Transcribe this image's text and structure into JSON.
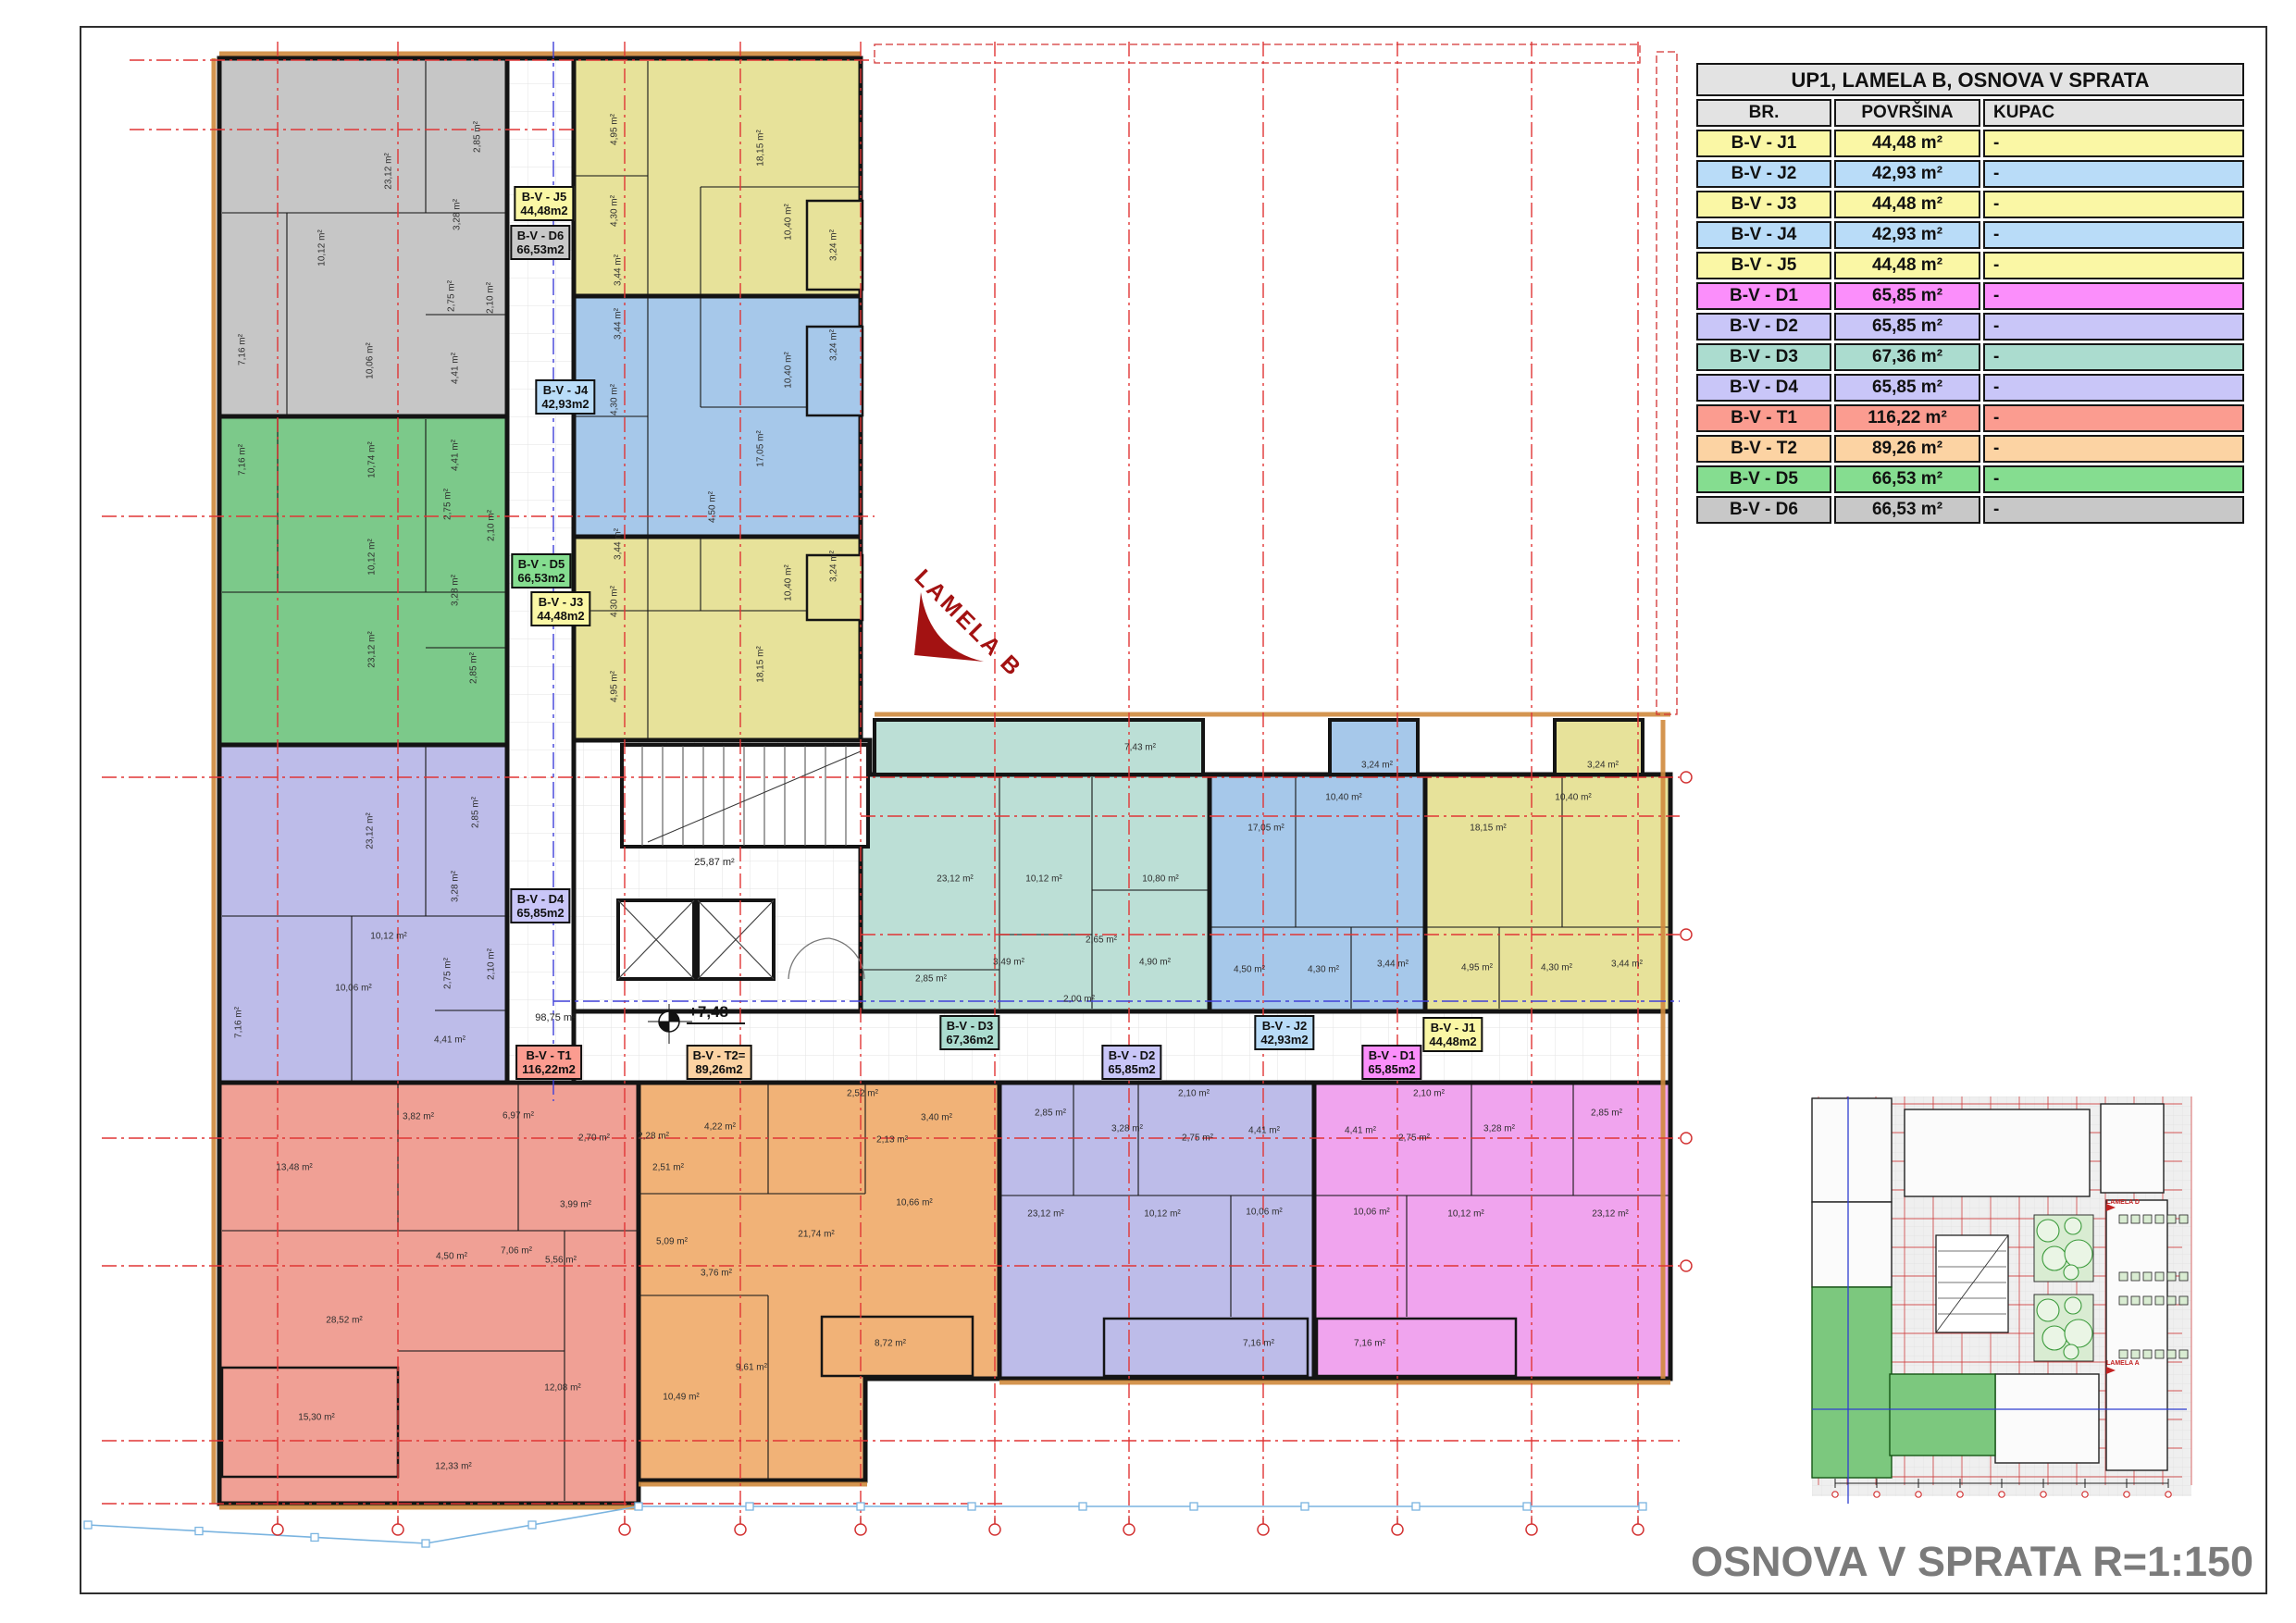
{
  "legend": {
    "title": "UP1, LAMELA B, OSNOVA V SPRATA",
    "columns": [
      "BR.",
      "POVRŠINA",
      "KUPAC"
    ],
    "header_bg": "#e3e3e3",
    "rows": [
      {
        "br": "B-V - J1",
        "area": "44,48 m²",
        "kupac": "-",
        "color": "#faf7a5"
      },
      {
        "br": "B-V - J2",
        "area": "42,93 m²",
        "kupac": "-",
        "color": "#b9dcf8"
      },
      {
        "br": "B-V - J3",
        "area": "44,48 m²",
        "kupac": "-",
        "color": "#faf7a5"
      },
      {
        "br": "B-V - J4",
        "area": "42,93 m²",
        "kupac": "-",
        "color": "#b9dcf8"
      },
      {
        "br": "B-V - J5",
        "area": "44,48 m²",
        "kupac": "-",
        "color": "#faf7a5"
      },
      {
        "br": "B-V - D1",
        "area": "65,85 m²",
        "kupac": "-",
        "color": "#fb8efb"
      },
      {
        "br": "B-V - D2",
        "area": "65,85 m²",
        "kupac": "-",
        "color": "#c9c6f8"
      },
      {
        "br": "B-V - D3",
        "area": "67,36 m²",
        "kupac": "-",
        "color": "#abdccf"
      },
      {
        "br": "B-V - D4",
        "area": "65,85 m²",
        "kupac": "-",
        "color": "#c9c6f8"
      },
      {
        "br": "B-V - T1",
        "area": "116,22 m²",
        "kupac": "-",
        "color": "#fb9c90"
      },
      {
        "br": "B-V - T2",
        "area": "89,26 m²",
        "kupac": "-",
        "color": "#fcd3a3"
      },
      {
        "br": "B-V - D5",
        "area": "66,53 m²",
        "kupac": "-",
        "color": "#85dd90"
      },
      {
        "br": "B-V - D6",
        "area": "66,53 m²",
        "kupac": "-",
        "color": "#c8c8c8"
      }
    ]
  },
  "caption": "OSNOVA V SPRATA R=1:150",
  "plan": {
    "wing_label": "LAMELA B",
    "level_marker": "+7,48",
    "corridor_area": "98,75 m²",
    "stair_area": "25,87 m²",
    "apartments": [
      {
        "id": "J5",
        "label": "B-V - J5",
        "area": "44,48m2",
        "fill": "#e7e29a",
        "label_bg": "#faf7a5",
        "rooms": [
          [
            "4,95 m²",
            664,
            140,
            1
          ],
          [
            "18,15 m²",
            822,
            160,
            1
          ],
          [
            "4,30 m²",
            664,
            228,
            1
          ],
          [
            "3,44 m²",
            668,
            292,
            1
          ],
          [
            "10,40 m²",
            852,
            240,
            1
          ],
          [
            "3,24 m²",
            901,
            265,
            1
          ]
        ]
      },
      {
        "id": "D6",
        "label": "B-V - D6",
        "area": "66,53m2",
        "fill": "#c6c6c6",
        "label_bg": "#c8c8c8",
        "rooms": [
          [
            "23,12 m²",
            420,
            185,
            1
          ],
          [
            "2,85 m²",
            516,
            148,
            1
          ],
          [
            "3,28 m²",
            494,
            232,
            1
          ],
          [
            "10,12 m²",
            348,
            268,
            1
          ],
          [
            "2,75 m²",
            488,
            320,
            1
          ],
          [
            "2,10 m²",
            530,
            322,
            1
          ],
          [
            "7,16 m²",
            262,
            378,
            1
          ],
          [
            "10,06 m²",
            400,
            390,
            1
          ],
          [
            "4,41 m²",
            492,
            398,
            1
          ]
        ]
      },
      {
        "id": "J4",
        "label": "B-V - J4",
        "area": "42,93m2",
        "fill": "#a6c8ea",
        "label_bg": "#b9dcf8",
        "rooms": [
          [
            "3,44 m²",
            668,
            350,
            1
          ],
          [
            "3,24 m²",
            901,
            373,
            1
          ],
          [
            "10,40 m²",
            852,
            400,
            1
          ],
          [
            "4,30 m²",
            664,
            432,
            1
          ],
          [
            "17,05 m²",
            822,
            485,
            1
          ],
          [
            "4,50 m²",
            770,
            548,
            1
          ]
        ]
      },
      {
        "id": "D5",
        "label": "B-V - D5",
        "area": "66,53m2",
        "fill": "#7cc98a",
        "label_bg": "#85dd90",
        "rooms": [
          [
            "7,16 m²",
            262,
            497,
            1
          ],
          [
            "10,74 m²",
            402,
            497,
            1
          ],
          [
            "4,41 m²",
            492,
            492,
            1
          ],
          [
            "2,75 m²",
            484,
            545,
            1
          ],
          [
            "2,10 m²",
            531,
            568,
            1
          ],
          [
            "10,12 m²",
            402,
            602,
            1
          ],
          [
            "3,28 m²",
            492,
            638,
            1
          ],
          [
            "23,12 m²",
            402,
            702,
            1
          ],
          [
            "2,85 m²",
            512,
            722,
            1
          ]
        ]
      },
      {
        "id": "J3",
        "label": "B-V - J3",
        "area": "44,48m2",
        "fill": "#e7e29a",
        "label_bg": "#faf7a5",
        "rooms": [
          [
            "3,44 m²",
            668,
            588,
            1
          ],
          [
            "4,30 m²",
            664,
            650,
            1
          ],
          [
            "10,40 m²",
            852,
            630,
            1
          ],
          [
            "3,24 m²",
            901,
            612,
            1
          ],
          [
            "18,15 m²",
            822,
            718,
            1
          ],
          [
            "4,95 m²",
            664,
            742,
            1
          ]
        ]
      },
      {
        "id": "D4",
        "label": "B-V - D4",
        "area": "65,85m2",
        "fill": "#bdbce9",
        "label_bg": "#c9c6f8",
        "rooms": [
          [
            "23,12 m²",
            400,
            898,
            1
          ],
          [
            "2,85 m²",
            514,
            878,
            1
          ],
          [
            "3,28 m²",
            492,
            958,
            1
          ],
          [
            "10,12 m²",
            420,
            1012,
            0
          ],
          [
            "2,75 m²",
            484,
            1052,
            1
          ],
          [
            "2,10 m²",
            531,
            1042,
            1
          ],
          [
            "10,06 m²",
            382,
            1068,
            0
          ],
          [
            "7,16 m²",
            258,
            1105,
            1
          ],
          [
            "4,41 m²",
            486,
            1124,
            0
          ]
        ]
      },
      {
        "id": "T1",
        "label": "B-V - T1",
        "area": "116,22m2",
        "fill": "#f0a095",
        "label_bg": "#fb9c90",
        "rooms": [
          [
            "13,48 m²",
            318,
            1262,
            0
          ],
          [
            "3,82 m²",
            452,
            1207,
            0
          ],
          [
            "6,97 m²",
            560,
            1206,
            0
          ],
          [
            "2,70 m²",
            642,
            1230,
            0
          ],
          [
            "3,99 m²",
            622,
            1302,
            0
          ],
          [
            "4,50 m²",
            488,
            1358,
            0
          ],
          [
            "7,06 m²",
            558,
            1352,
            0
          ],
          [
            "5,56 m²",
            606,
            1362,
            0
          ],
          [
            "28,52 m²",
            372,
            1427,
            0
          ],
          [
            "15,30 m²",
            342,
            1532,
            0
          ],
          [
            "12,33 m²",
            490,
            1585,
            0
          ],
          [
            "12,08 m²",
            608,
            1500,
            0
          ]
        ]
      },
      {
        "id": "T2",
        "label": "B-V - T2=",
        "area": "89,26m2",
        "fill": "#f1b277",
        "label_bg": "#fcd3a3",
        "rooms": [
          [
            "2,28 m²",
            706,
            1228,
            0
          ],
          [
            "4,22 m²",
            778,
            1218,
            0
          ],
          [
            "2,52 m²",
            932,
            1182,
            0
          ],
          [
            "2,51 m²",
            722,
            1262,
            0
          ],
          [
            "5,09 m²",
            726,
            1342,
            0
          ],
          [
            "3,76 m²",
            774,
            1376,
            0
          ],
          [
            "21,74 m²",
            882,
            1334,
            0
          ],
          [
            "2,13 m²",
            964,
            1232,
            0
          ],
          [
            "3,40 m²",
            1012,
            1208,
            0
          ],
          [
            "10,66 m²",
            988,
            1300,
            0
          ],
          [
            "9,61 m²",
            812,
            1478,
            0
          ],
          [
            "10,49 m²",
            736,
            1510,
            0
          ],
          [
            "8,72 m²",
            962,
            1452,
            0
          ]
        ]
      },
      {
        "id": "D3",
        "label": "B-V - D3",
        "area": "67,36m2",
        "fill": "#bcdfd6",
        "label_bg": "#abdccf",
        "rooms": [
          [
            "7,43 m²",
            1232,
            808,
            0
          ],
          [
            "23,12 m²",
            1032,
            950,
            0
          ],
          [
            "10,12 m²",
            1128,
            950,
            0
          ],
          [
            "10,80 m²",
            1254,
            950,
            0
          ],
          [
            "2,65 m²",
            1190,
            1016,
            0
          ],
          [
            "3,49 m²",
            1090,
            1040,
            0
          ],
          [
            "4,90 m²",
            1248,
            1040,
            0
          ],
          [
            "2,85 m²",
            1006,
            1058,
            0
          ],
          [
            "2,00 m²",
            1166,
            1080,
            0
          ]
        ]
      },
      {
        "id": "J2",
        "label": "B-V - J2",
        "area": "42,93m2",
        "fill": "#a6c8ea",
        "label_bg": "#b9dcf8",
        "rooms": [
          [
            "3,24 m²",
            1488,
            827,
            0
          ],
          [
            "10,40 m²",
            1452,
            862,
            0
          ],
          [
            "17,05 m²",
            1368,
            895,
            0
          ],
          [
            "4,50 m²",
            1350,
            1048,
            0
          ],
          [
            "4,30 m²",
            1430,
            1048,
            0
          ],
          [
            "3,44 m²",
            1505,
            1042,
            0
          ]
        ]
      },
      {
        "id": "J1",
        "label": "B-V - J1",
        "area": "44,48m2",
        "fill": "#e7e29a",
        "label_bg": "#faf7a5",
        "rooms": [
          [
            "3,24 m²",
            1732,
            827,
            0
          ],
          [
            "10,40 m²",
            1700,
            862,
            0
          ],
          [
            "18,15 m²",
            1608,
            895,
            0
          ],
          [
            "4,95 m²",
            1596,
            1046,
            0
          ],
          [
            "4,30 m²",
            1682,
            1046,
            0
          ],
          [
            "3,44 m²",
            1758,
            1042,
            0
          ]
        ]
      },
      {
        "id": "D2",
        "label": "B-V - D2",
        "area": "65,85m2",
        "fill": "#bdbce9",
        "label_bg": "#c9c6f8",
        "rooms": [
          [
            "2,85 m²",
            1135,
            1203,
            0
          ],
          [
            "2,10 m²",
            1290,
            1182,
            0
          ],
          [
            "3,28 m²",
            1218,
            1220,
            0
          ],
          [
            "2,75 m²",
            1294,
            1230,
            0
          ],
          [
            "4,41 m²",
            1366,
            1222,
            0
          ],
          [
            "23,12 m²",
            1130,
            1312,
            0
          ],
          [
            "10,12 m²",
            1256,
            1312,
            0
          ],
          [
            "10,06 m²",
            1366,
            1310,
            0
          ],
          [
            "7,16 m²",
            1360,
            1452,
            0
          ]
        ]
      },
      {
        "id": "D1",
        "label": "B-V - D1",
        "area": "65,85m2",
        "fill": "#f0a4ee",
        "label_bg": "#fb8efb",
        "rooms": [
          [
            "4,41 m²",
            1470,
            1222,
            0
          ],
          [
            "2,10 m²",
            1544,
            1182,
            0
          ],
          [
            "2,75 m²",
            1528,
            1230,
            0
          ],
          [
            "3,28 m²",
            1620,
            1220,
            0
          ],
          [
            "10,06 m²",
            1482,
            1310,
            0
          ],
          [
            "10,12 m²",
            1584,
            1312,
            0
          ],
          [
            "23,12 m²",
            1740,
            1312,
            0
          ],
          [
            "2,85 m²",
            1736,
            1203,
            0
          ],
          [
            "7,16 m²",
            1480,
            1452,
            0
          ]
        ]
      }
    ]
  },
  "overview": {
    "lamela_d": "LAMELA D",
    "lamela_a": "LAMELA A"
  }
}
